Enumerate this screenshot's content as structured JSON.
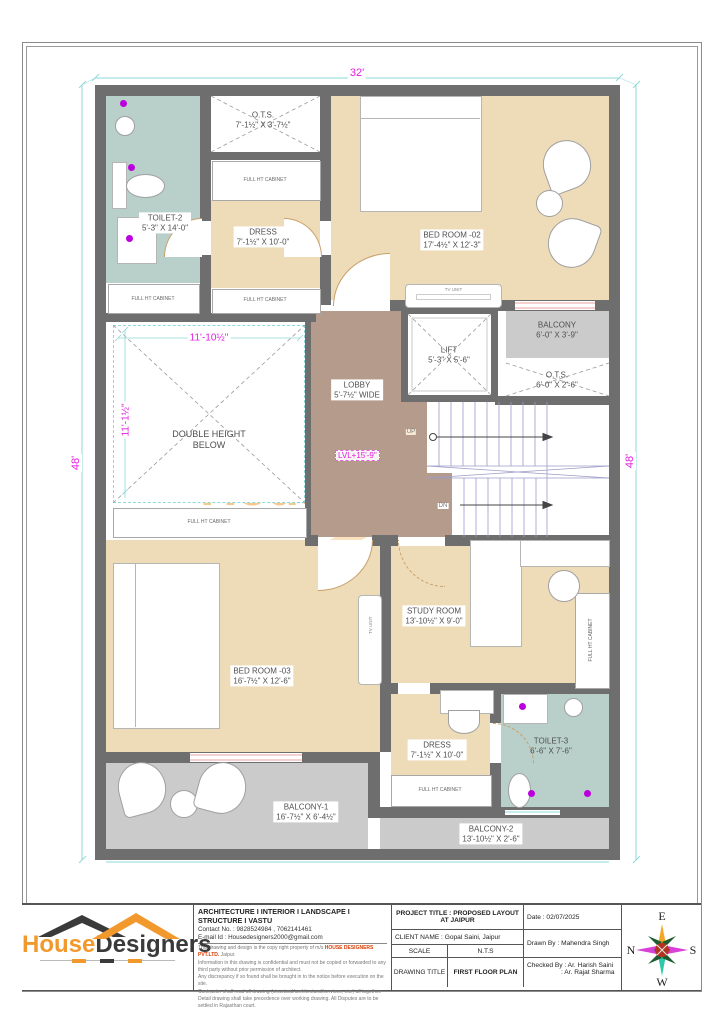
{
  "dimensions": {
    "top": "32'",
    "left": "48'",
    "right": "48'",
    "dh_width": "11'-10½\"",
    "dh_height": "11'-1½\"",
    "level": "LVL+15'-9\""
  },
  "rooms": {
    "toilet2": {
      "name": "TOILET-2",
      "size": "5'-3\" X 14'-0\""
    },
    "ots_top": {
      "name": "O.T.S.",
      "size": "7'-1½\" X 3'-7½\""
    },
    "dress_top": {
      "name": "DRESS",
      "size": "7'-1½\" X 10'-0\""
    },
    "bedroom2": {
      "name": "BED ROOM -02",
      "size": "17'-4½\" X 12'-3\""
    },
    "balcony_top": {
      "name": "BALCONY",
      "size": "6'-0\" X 3'-9\""
    },
    "ots_right": {
      "name": "O.T.S.",
      "size": "6'-0\" X 2'-6\""
    },
    "lift": {
      "name": "LIFT",
      "size": "5'-3\" X 5'-6\""
    },
    "lobby": {
      "name": "LOBBY",
      "size": "5'-7½\" WIDE"
    },
    "double_height": {
      "name": "DOUBLE HEIGHT",
      "size": "BELOW"
    },
    "bedroom3": {
      "name": "BED ROOM -03",
      "size": "16'-7½\" X 12'-6\""
    },
    "study": {
      "name": "STUDY ROOM",
      "size": "13'-10½\" X 9'-0\""
    },
    "dress_bottom": {
      "name": "DRESS",
      "size": "7'-1½\" X 10'-0\""
    },
    "toilet3": {
      "name": "TOILET-3",
      "size": "6'-6\" X 7'-6\""
    },
    "balcony1": {
      "name": "BALCONY-1",
      "size": "16'-7½\" X 6'-4½\""
    },
    "balcony2": {
      "name": "BALCONY-2",
      "size": "13'-10½\" X 2'-6\""
    }
  },
  "annotations": {
    "cabinet": "FULL HT CABINET",
    "tv_unit": "TV UNIT",
    "up": "UP",
    "dn": "DN"
  },
  "watermark": {
    "part1": "House",
    "part2": "Designers"
  },
  "titleblock": {
    "logo": {
      "part1": "House",
      "part2": "Designers"
    },
    "tagline": "ARCHITECTURE I INTERIOR I LANDSCAPE I STRUCTURE I VASTU",
    "contact": "Contact No. : 9828524984 , 7062141461",
    "email": "E-mail Id : Housedesigners2000@gmail.com",
    "disclaimer_1a": "This drawing and design is the copy right property of m/s ",
    "disclaimer_1b": "HOUSE DESIGNERS PVT.LTD.",
    "disclaimer_1c": " Jaipur.",
    "disclaimer": [
      "Information in this drawing is confidential and must not be copied or forwarded to any third party without prior permission of architect.",
      "Any discrepancy if so found shall be brought in to the notice before execution on the site.",
      "Contractor shall read all drawing (structural/architectural/services, etc.) all together.",
      "Detail drawing shall take precedence over working drawing.",
      "All Disputes are to be settled in Rajasthan court."
    ],
    "project_title": "PROJECT TITLE : PROPOSED LAYOUT AT JAIPUR",
    "date": "Date : 02/07/2025",
    "client": "CLIENT NAME : Gopal Saini, Jaipur",
    "drawn_by": "Drawn By : Mahendra Singh",
    "scale_label": "SCALE",
    "scale_value": "N.T.S",
    "drawing_title_label": "DRAWING TITLE",
    "drawing_title_value": "FIRST FLOOR PLAN",
    "checked_by_1": "Checked By : Ar. Harish Saini",
    "checked_by_2": ": Ar. Rajat Sharma"
  },
  "compass": {
    "n": "N",
    "e": "E",
    "s": "S",
    "w": "W"
  },
  "colors": {
    "wall": "#6e6e6e",
    "floor_beige": "#eedcb8",
    "floor_teal": "#b9cfc9",
    "floor_brown": "#b59b8c",
    "floor_gray": "#cbcbcb",
    "dimension_magenta": "#e01fe0",
    "dimension_cyan": "#8fd8d8",
    "logo_orange": "#f2992e",
    "logo_dark": "#3a3a3a",
    "brand_red": "#d93a00"
  }
}
